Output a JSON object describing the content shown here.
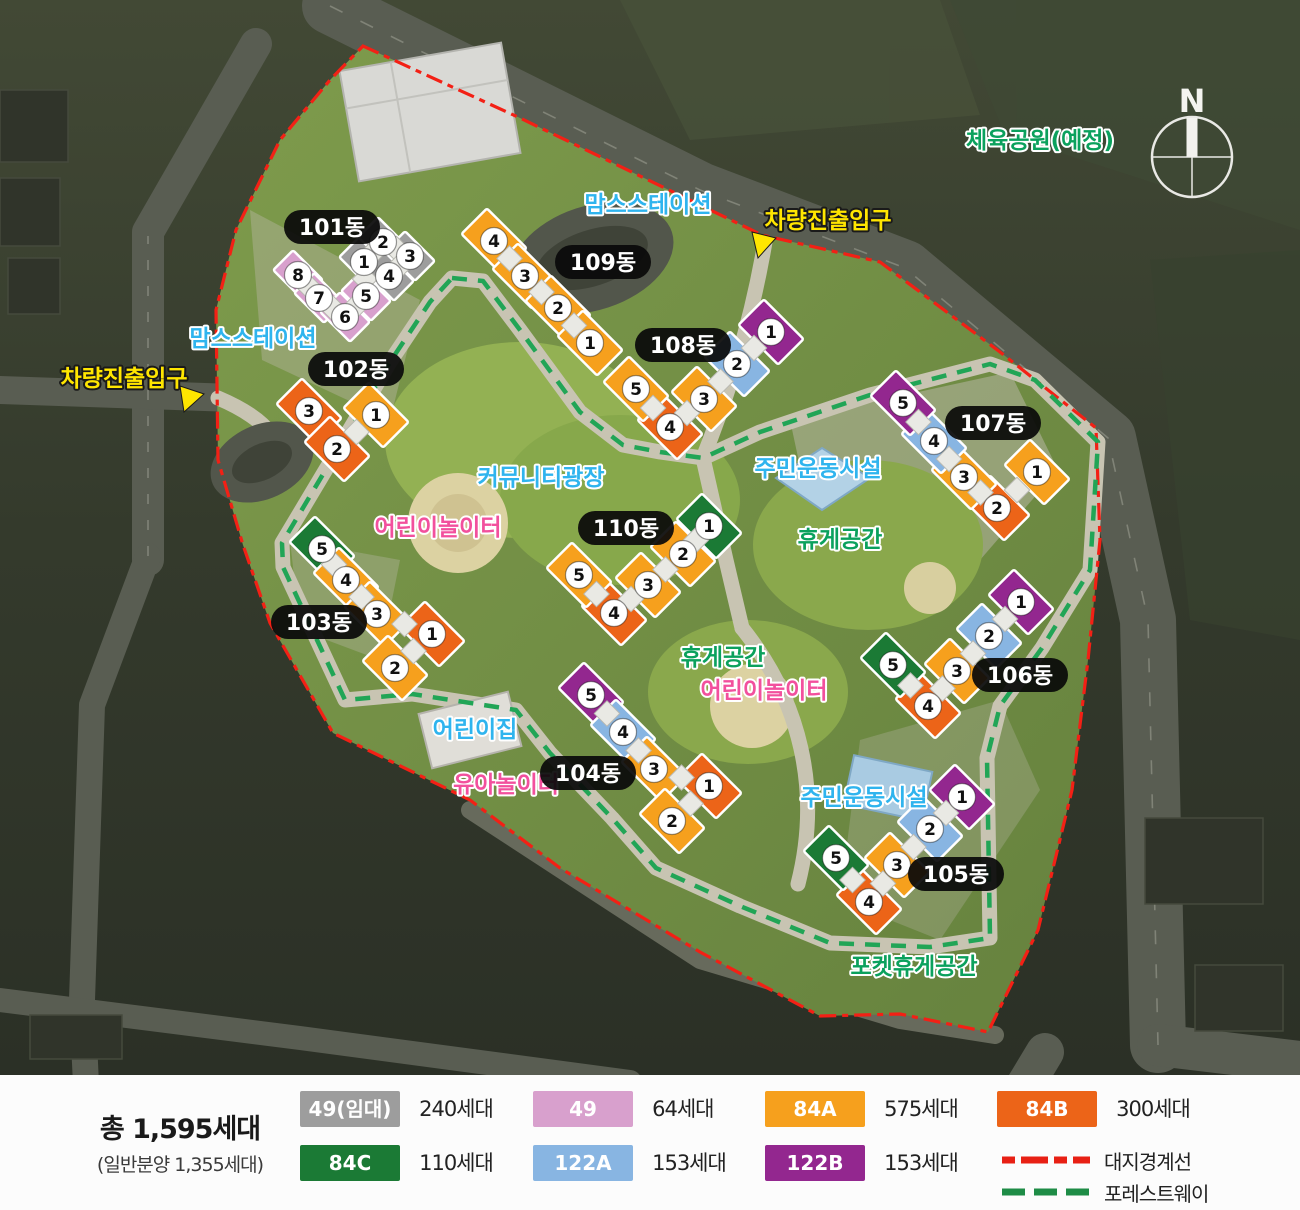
{
  "map": {
    "compass_label": "N"
  },
  "unit_types": {
    "49R": {
      "code": "49(임대)",
      "color": "#9d9d9d"
    },
    "49": {
      "code": "49",
      "color": "#d8a0cd"
    },
    "84A": {
      "code": "84A",
      "color": "#f6a01d"
    },
    "84B": {
      "code": "84B",
      "color": "#ec6418"
    },
    "84C": {
      "code": "84C",
      "color": "#1b7a35"
    },
    "122A": {
      "code": "122A",
      "color": "#88b5e2"
    },
    "122B": {
      "code": "122B",
      "color": "#93278f"
    }
  },
  "buildings": [
    {
      "label": "101동",
      "lx": 332,
      "ly": 227,
      "seg_w": 42,
      "seg_h": 28,
      "units": [
        {
          "n": "8",
          "x": 298,
          "y": 275,
          "type": "49"
        },
        {
          "n": "7",
          "x": 319,
          "y": 298,
          "type": "49"
        },
        {
          "n": "6",
          "x": 345,
          "y": 317,
          "type": "49"
        },
        {
          "n": "5",
          "x": 366,
          "y": 296,
          "type": "49"
        },
        {
          "n": "1",
          "x": 364,
          "y": 262,
          "type": "49R"
        },
        {
          "n": "2",
          "x": 383,
          "y": 242,
          "type": "49R"
        },
        {
          "n": "3",
          "x": 410,
          "y": 256,
          "type": "49R"
        },
        {
          "n": "4",
          "x": 389,
          "y": 276,
          "type": "49R"
        }
      ]
    },
    {
      "label": "102동",
      "lx": 356,
      "ly": 369,
      "units": [
        {
          "n": "3",
          "x": 309,
          "y": 411,
          "type": "84B"
        },
        {
          "n": "1",
          "x": 376,
          "y": 415,
          "type": "84A"
        },
        {
          "n": "2",
          "x": 337,
          "y": 449,
          "type": "84B"
        }
      ]
    },
    {
      "label": "103동",
      "lx": 319,
      "ly": 622,
      "units": [
        {
          "n": "5",
          "x": 322,
          "y": 549,
          "type": "84C"
        },
        {
          "n": "4",
          "x": 346,
          "y": 580,
          "type": "84A"
        },
        {
          "n": "3",
          "x": 377,
          "y": 614,
          "type": "84A"
        },
        {
          "n": "1",
          "x": 432,
          "y": 634,
          "type": "84B"
        },
        {
          "n": "2",
          "x": 395,
          "y": 668,
          "type": "84A"
        }
      ]
    },
    {
      "label": "104동",
      "lx": 588,
      "ly": 773,
      "units": [
        {
          "n": "5",
          "x": 591,
          "y": 695,
          "type": "122B"
        },
        {
          "n": "4",
          "x": 623,
          "y": 732,
          "type": "122A"
        },
        {
          "n": "3",
          "x": 654,
          "y": 769,
          "type": "84A"
        },
        {
          "n": "1",
          "x": 709,
          "y": 786,
          "type": "84B"
        },
        {
          "n": "2",
          "x": 672,
          "y": 821,
          "type": "84A"
        }
      ]
    },
    {
      "label": "105동",
      "lx": 956,
      "ly": 874,
      "units": [
        {
          "n": "1",
          "x": 962,
          "y": 797,
          "type": "122B"
        },
        {
          "n": "2",
          "x": 930,
          "y": 829,
          "type": "122A"
        },
        {
          "n": "3",
          "x": 897,
          "y": 865,
          "type": "84A"
        },
        {
          "n": "4",
          "x": 869,
          "y": 902,
          "type": "84B"
        },
        {
          "n": "5",
          "x": 836,
          "y": 858,
          "type": "84C"
        }
      ]
    },
    {
      "label": "106동",
      "lx": 1020,
      "ly": 675,
      "units": [
        {
          "n": "1",
          "x": 1021,
          "y": 602,
          "type": "122B"
        },
        {
          "n": "2",
          "x": 989,
          "y": 636,
          "type": "122A"
        },
        {
          "n": "3",
          "x": 957,
          "y": 671,
          "type": "84A"
        },
        {
          "n": "4",
          "x": 928,
          "y": 706,
          "type": "84B"
        },
        {
          "n": "5",
          "x": 893,
          "y": 665,
          "type": "84C"
        }
      ]
    },
    {
      "label": "107동",
      "lx": 993,
      "ly": 423,
      "units": [
        {
          "n": "1",
          "x": 1037,
          "y": 472,
          "type": "84A"
        },
        {
          "n": "2",
          "x": 997,
          "y": 508,
          "type": "84B"
        },
        {
          "n": "3",
          "x": 964,
          "y": 477,
          "type": "84A"
        },
        {
          "n": "4",
          "x": 934,
          "y": 441,
          "type": "122A"
        },
        {
          "n": "5",
          "x": 903,
          "y": 403,
          "type": "122B"
        }
      ]
    },
    {
      "label": "108동",
      "lx": 683,
      "ly": 345,
      "units": [
        {
          "n": "1",
          "x": 771,
          "y": 332,
          "type": "122B"
        },
        {
          "n": "2",
          "x": 737,
          "y": 364,
          "type": "122A"
        },
        {
          "n": "3",
          "x": 704,
          "y": 399,
          "type": "84A"
        },
        {
          "n": "4",
          "x": 670,
          "y": 427,
          "type": "84B"
        },
        {
          "n": "5",
          "x": 636,
          "y": 389,
          "type": "84A"
        }
      ]
    },
    {
      "label": "109동",
      "lx": 603,
      "ly": 262,
      "units": [
        {
          "n": "4",
          "x": 494,
          "y": 241,
          "type": "84A"
        },
        {
          "n": "3",
          "x": 525,
          "y": 276,
          "type": "84A"
        },
        {
          "n": "2",
          "x": 558,
          "y": 308,
          "type": "84A"
        },
        {
          "n": "1",
          "x": 590,
          "y": 343,
          "type": "84A"
        }
      ]
    },
    {
      "label": "110동",
      "lx": 626,
      "ly": 528,
      "units": [
        {
          "n": "1",
          "x": 709,
          "y": 526,
          "type": "84C"
        },
        {
          "n": "2",
          "x": 683,
          "y": 554,
          "type": "84A"
        },
        {
          "n": "3",
          "x": 648,
          "y": 585,
          "type": "84A"
        },
        {
          "n": "4",
          "x": 614,
          "y": 613,
          "type": "84B"
        },
        {
          "n": "5",
          "x": 579,
          "y": 575,
          "type": "84A"
        }
      ]
    }
  ],
  "facility_labels": [
    {
      "text": "체육공원(예정)",
      "x": 1040,
      "y": 148,
      "color": "green"
    },
    {
      "text": "맘스스테이션",
      "x": 648,
      "y": 212,
      "color": "blue"
    },
    {
      "text": "차량진출입구",
      "x": 828,
      "y": 228,
      "color": "yellow",
      "arrow": "752,232 776,238 758,258"
    },
    {
      "text": "맘스스테이션",
      "x": 253,
      "y": 346,
      "color": "blue"
    },
    {
      "text": "차량진출입구",
      "x": 124,
      "y": 386,
      "color": "yellow",
      "arrow": "180,386 204,394 184,412"
    },
    {
      "text": "커뮤니티광장",
      "x": 541,
      "y": 485,
      "color": "blue"
    },
    {
      "text": "어린이놀이터",
      "x": 438,
      "y": 535,
      "color": "pink"
    },
    {
      "text": "주민운동시설",
      "x": 818,
      "y": 476,
      "color": "blue"
    },
    {
      "text": "휴게공간",
      "x": 840,
      "y": 547,
      "color": "green"
    },
    {
      "text": "휴게공간",
      "x": 723,
      "y": 665,
      "color": "green"
    },
    {
      "text": "어린이놀이터",
      "x": 764,
      "y": 698,
      "color": "pink"
    },
    {
      "text": "어린이집",
      "x": 475,
      "y": 737,
      "color": "blue"
    },
    {
      "text": "유아놀이터",
      "x": 506,
      "y": 792,
      "color": "pink"
    },
    {
      "text": "주민운동시설",
      "x": 864,
      "y": 805,
      "color": "blue"
    },
    {
      "text": "포켓휴게공간",
      "x": 914,
      "y": 974,
      "color": "green"
    }
  ],
  "legend": {
    "total": "총 1,595세대",
    "subtotal": "(일반분양 1,355세대)",
    "items": [
      {
        "code": "49(임대)",
        "color": "#9d9d9d",
        "count": "240세대"
      },
      {
        "code": "49",
        "color": "#d8a0cd",
        "count": "64세대"
      },
      {
        "code": "84A",
        "color": "#f6a01d",
        "count": "575세대"
      },
      {
        "code": "84B",
        "color": "#ec6418",
        "count": "300세대"
      },
      {
        "code": "84C",
        "color": "#1b7a35",
        "count": "110세대"
      },
      {
        "code": "122A",
        "color": "#88b5e2",
        "count": "153세대"
      },
      {
        "code": "122B",
        "color": "#93278f",
        "count": "153세대"
      }
    ],
    "lines": [
      {
        "label": "대지경계선",
        "color": "#e82014"
      },
      {
        "label": "포레스트웨이",
        "color": "#1e8c46"
      }
    ]
  }
}
